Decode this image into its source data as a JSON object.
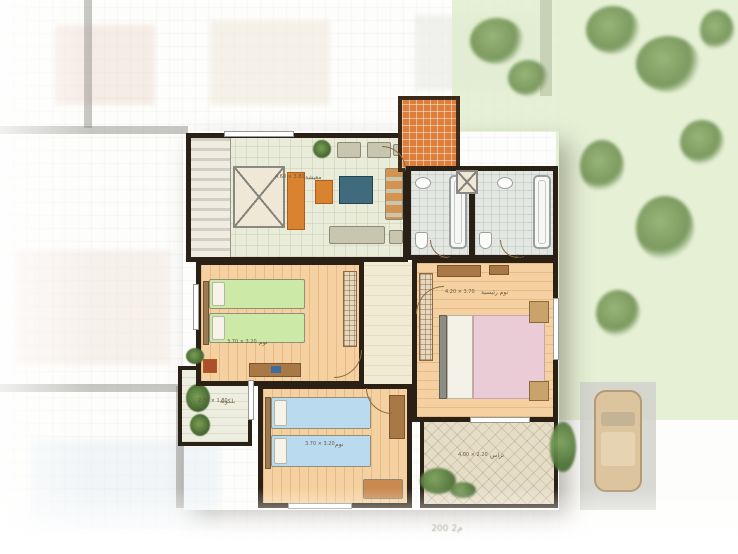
{
  "caption": "200 م2",
  "colors": {
    "wall": "#2a2015",
    "living_floor": "#e9ecd8",
    "bedroom_floor": "#f5d1a1",
    "bath_floor": "#e3e7e2",
    "corridor_floor": "#f2ebd3",
    "entrance_tile": "#dd7f3a",
    "terrace_floor": "#e6ddc7",
    "balcony_floor": "#edeee0",
    "bed_green": "#cde9a7",
    "bed_blue": "#badaf0",
    "bed_pink": "#eaccd6",
    "sofa_gray": "#c9c6b0",
    "accent_orange": "#d9822f",
    "wood_brown": "#a87847",
    "lawn_green": "#dfeccc",
    "label_ink": "#6a5a42"
  },
  "rooms": [
    {
      "id": "living",
      "label": "معيشة",
      "dims": "4.60 × 3.80"
    },
    {
      "id": "bedroom-1",
      "label": "نوم",
      "dims": "3.70 × 3.20"
    },
    {
      "id": "bedroom-2",
      "label": "نوم",
      "dims": "3.70 × 3.20"
    },
    {
      "id": "master",
      "label": "نوم رئيسية",
      "dims": "4.20 × 3.70"
    },
    {
      "id": "bath-1",
      "label": "حمام",
      "dims": ""
    },
    {
      "id": "bath-2",
      "label": "حمام",
      "dims": ""
    },
    {
      "id": "terrace",
      "label": "تراس",
      "dims": "4.00 × 2.20"
    },
    {
      "id": "balcony",
      "label": "بلكونة",
      "dims": "2.00 × 1.80"
    }
  ]
}
